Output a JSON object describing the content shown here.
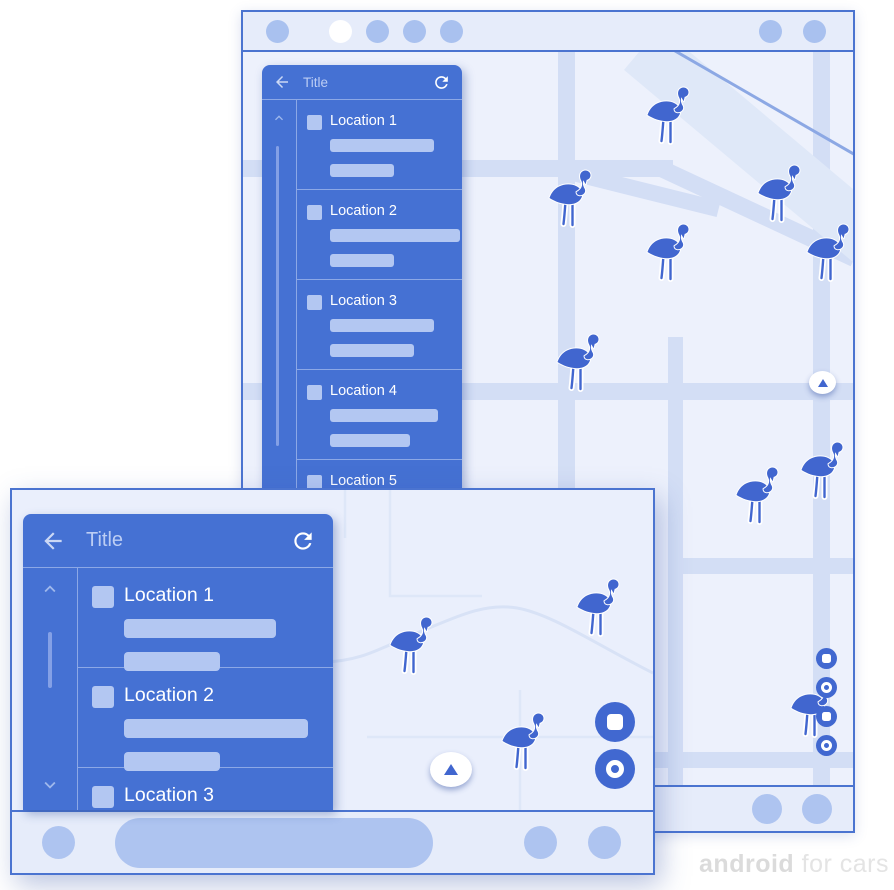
{
  "watermark": {
    "bold": "android",
    "rest": " for cars"
  },
  "colors": {
    "primary_blue": "#4571D3",
    "marker_blue": "#4166CF",
    "light_accent": "#AEC4F0",
    "frame_border": "#4B74D0",
    "chrome_background": "#E6ECFA",
    "map_background": "#EDF1FC",
    "map_road": "#D3DEF5",
    "watermark_gray": "#DFDFDF"
  },
  "icons": {
    "back": "arrow-left",
    "refresh": "refresh-clockwise",
    "scroll_up": "chevron-up",
    "scroll_down": "chevron-down",
    "list_item": "square-placeholder",
    "map_marker": "flamingo",
    "compass": "triangle-up",
    "action_square": "square-in-circle",
    "action_circle": "ring-in-circle"
  },
  "portrait": {
    "status_bar": {
      "dots": [
        "accent",
        "white",
        "accent",
        "accent",
        "accent"
      ],
      "right_dots": [
        "accent",
        "accent"
      ]
    },
    "panel": {
      "title": "Title",
      "items": [
        {
          "label": "Location 1",
          "bar_widths": [
            104,
            64
          ]
        },
        {
          "label": "Location 2",
          "bar_widths": [
            130,
            64
          ]
        },
        {
          "label": "Location 3",
          "bar_widths": [
            104,
            84
          ]
        },
        {
          "label": "Location 4",
          "bar_widths": [
            108,
            80
          ]
        },
        {
          "label": "Location 5",
          "bar_widths": [
            104,
            64
          ]
        }
      ]
    },
    "map": {
      "markers": [
        {
          "x": 403,
          "y": 33
        },
        {
          "x": 305,
          "y": 116
        },
        {
          "x": 403,
          "y": 170
        },
        {
          "x": 514,
          "y": 111
        },
        {
          "x": 563,
          "y": 170
        },
        {
          "x": 313,
          "y": 280
        },
        {
          "x": 492,
          "y": 413
        },
        {
          "x": 557,
          "y": 388
        },
        {
          "x": 547,
          "y": 626
        }
      ],
      "action_buttons": [
        "square",
        "circle",
        "square",
        "circle"
      ]
    },
    "bottom_bar": {
      "dots": [
        "accent",
        "accent"
      ]
    }
  },
  "landscape": {
    "panel": {
      "title": "Title",
      "items": [
        {
          "label": "Location 1",
          "bar_widths": [
            152,
            96
          ]
        },
        {
          "label": "Location 2",
          "bar_widths": [
            184,
            96
          ]
        },
        {
          "label": "Location 3",
          "bar_widths": [
            152,
            96
          ]
        }
      ]
    },
    "map": {
      "markers": [
        {
          "x": 377,
          "y": 125
        },
        {
          "x": 564,
          "y": 87
        },
        {
          "x": 489,
          "y": 221
        }
      ],
      "action_buttons": [
        "square",
        "circle"
      ]
    },
    "bottom_bar": {
      "left_dots": [
        "accent"
      ],
      "right_dots": [
        "accent",
        "accent"
      ]
    }
  }
}
